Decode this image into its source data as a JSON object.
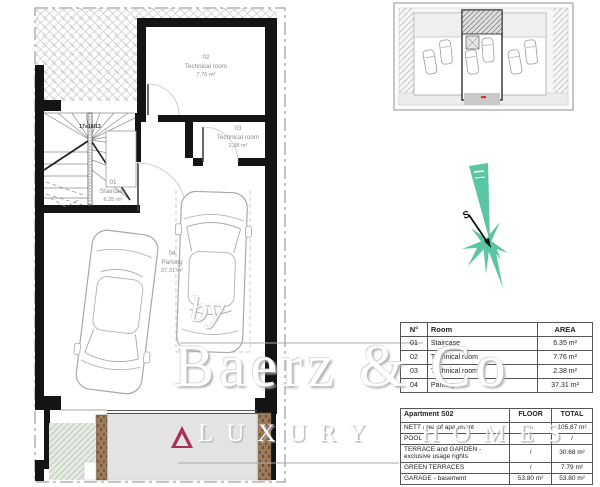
{
  "plan": {
    "stair_note": "17x18/13",
    "rooms": [
      {
        "number": "01",
        "name": "Staircase",
        "area": "6,35 m²"
      },
      {
        "number": "02",
        "name": "Technical room",
        "area": "7,76 m²"
      },
      {
        "number": "03",
        "name": "Technical room",
        "area": "2,38 m²"
      },
      {
        "number": "04",
        "name": "Parking",
        "area": "37,31 m²"
      }
    ]
  },
  "compass": {
    "south_label": "S",
    "rose_color": "#5cc6a4"
  },
  "room_table": {
    "col_headers": [
      "N°",
      "Room",
      "AREA"
    ],
    "rows": [
      {
        "no": "01",
        "room": "Staircase",
        "area": "6.35 m²"
      },
      {
        "no": "02",
        "room": "Technical room",
        "area": "7.76 m²"
      },
      {
        "no": "03",
        "room": "Technical room",
        "area": "2.38 m²"
      },
      {
        "no": "04",
        "room": "Parking",
        "area": "37.31 m²"
      }
    ]
  },
  "summary_table": {
    "title": "Apartment S02",
    "floor_header": "FLOOR",
    "total_header": "TOTAL",
    "rows": [
      {
        "label": "NETT area of apartment",
        "floor": "/",
        "total": "105.87 m²"
      },
      {
        "label": "POOL",
        "floor": "/",
        "total": "/"
      },
      {
        "label": "TERRACE and GARDEN - exclusive usage rights",
        "floor": "/",
        "total": "30.68 m²"
      },
      {
        "label": "GREEN TERRACES",
        "floor": "/",
        "total": "7.79 m²"
      },
      {
        "label": "GARAGE - basement",
        "floor": "53.80 m²",
        "total": "53.80 m²"
      }
    ]
  },
  "watermark": {
    "prefix": "by",
    "brand": "Baerz & Co",
    "tagline": "LUXURY HOMES",
    "logo_color": "#a63058"
  }
}
